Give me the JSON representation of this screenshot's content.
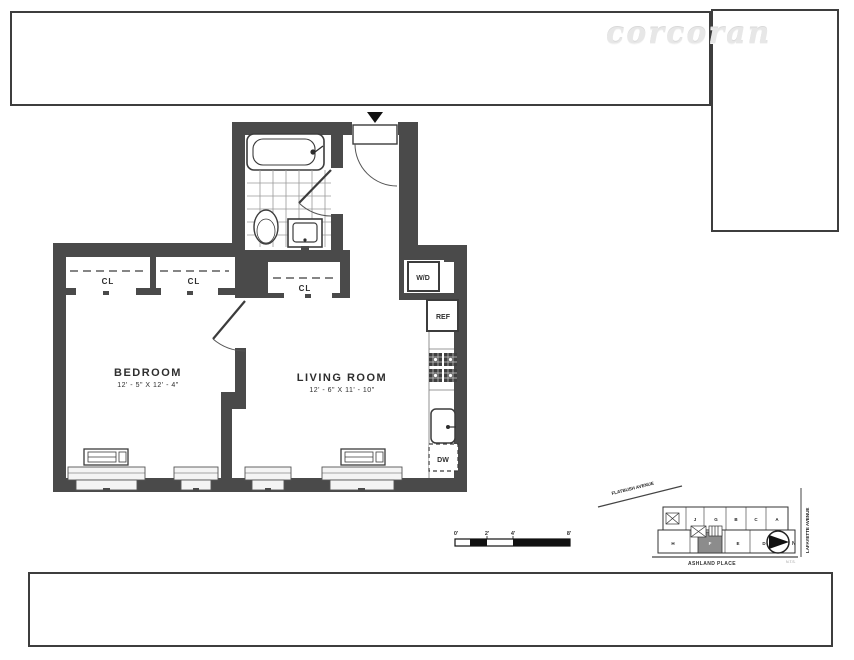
{
  "watermark": "corcoran",
  "plan": {
    "bedroom_label": "BEDROOM",
    "bedroom_dims": "12' - 5\" X 12' - 4\"",
    "living_label": "LIVING ROOM",
    "living_dims": "12' - 6\" X 11' - 10\"",
    "closet1": "CL",
    "closet2": "CL",
    "closet3": "CL",
    "washer_dryer": "W/D",
    "fridge": "REF",
    "dishwasher": "DW"
  },
  "scale_bar": {
    "t0": "0'",
    "t1": "2'",
    "t2": "4'",
    "t3": "8'"
  },
  "site_plan": {
    "street_diagonal": "FLATBUSH AVENUE",
    "street_right": "LAFAYETTE AVENUE",
    "street_bottom": "ASHLAND PLACE",
    "north": "N",
    "note": "N.T.S.",
    "units_top": [
      "J",
      "G",
      "B",
      "C",
      "A"
    ],
    "units_bottom": [
      "H",
      "F",
      "E",
      "D"
    ],
    "highlighted_unit": "F"
  },
  "colors": {
    "wall": "#4a4a4a",
    "ink": "#2e2e2e",
    "unit_highlight": "#8c8c8c"
  }
}
